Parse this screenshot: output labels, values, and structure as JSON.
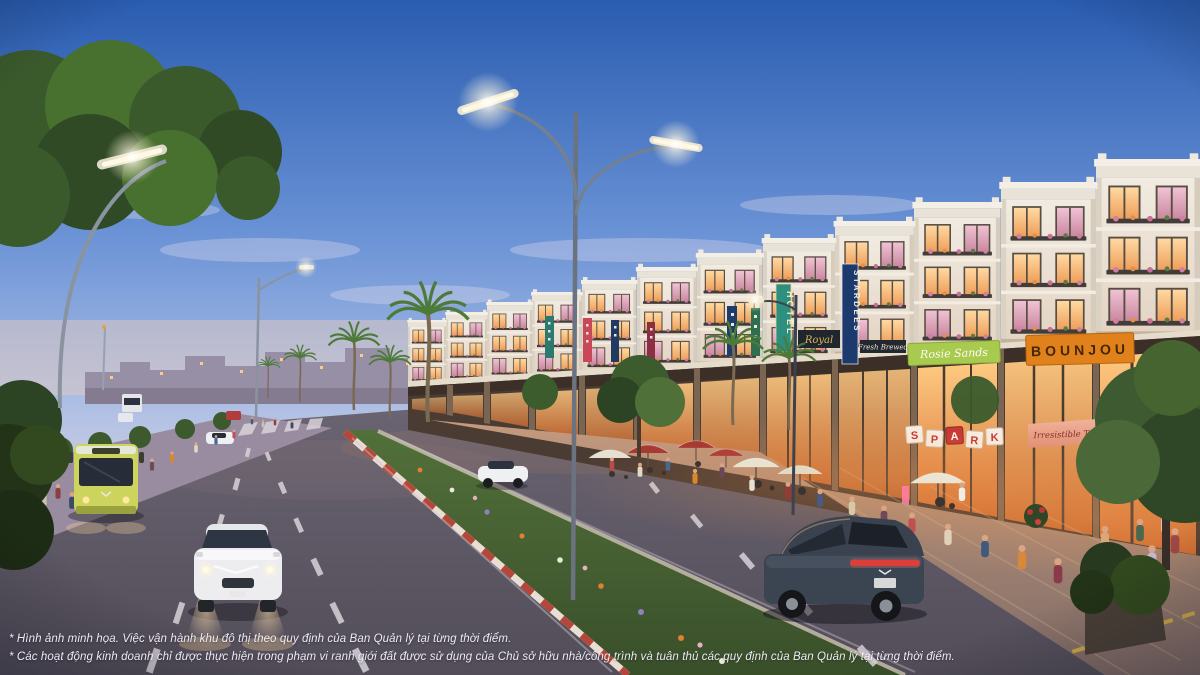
{
  "scene": {
    "type": "dusk-street-render",
    "subject": "Shophouse boulevard with sidewalk cafes, median planting, streetlights and vehicles"
  },
  "disclaimers": {
    "line1": "* Hình ảnh minh họa. Việc vận hành khu đô thị theo quy định của Ban Quản lý tại từng thời điểm.",
    "line2": "* Các hoạt động kinh doanh chỉ được thực hiện trong phạm vi ranh giới đất được sử dụng của Chủ sở hữu nhà/công trình và tuân thủ các quy định của Ban Quản lý tại từng thời điểm."
  },
  "signs": {
    "hotel_vertical": "HOTEL",
    "royal": "Royal",
    "stardees_vertical": "STARDEES",
    "fresh_brewed": "Fresh Brewed",
    "rosie_sands": "Rosie Sands",
    "bounjou": "BOUNJOU",
    "boutique_awning": "Irresistible Taste",
    "spark_letters": [
      "S",
      "P",
      "A",
      "R",
      "K"
    ]
  },
  "colors": {
    "sky_top": "#2a5cb0",
    "sky_horizon": "#e8d9d3",
    "facade_cream": "#efe9de",
    "window_glow": "#ffd9a2",
    "storefront_glow": "#ffca82",
    "sign_bounjou_bg": "#e0811c",
    "sign_rosie_bg": "#a8ca4e",
    "sign_hotel_bg": "#2d8f80",
    "sign_stardees_bg": "#1d3a6e",
    "median_curb_red": "#b5473a",
    "bus_yellow_green": "#cdd45e",
    "road_asphalt": "#5e5864"
  }
}
